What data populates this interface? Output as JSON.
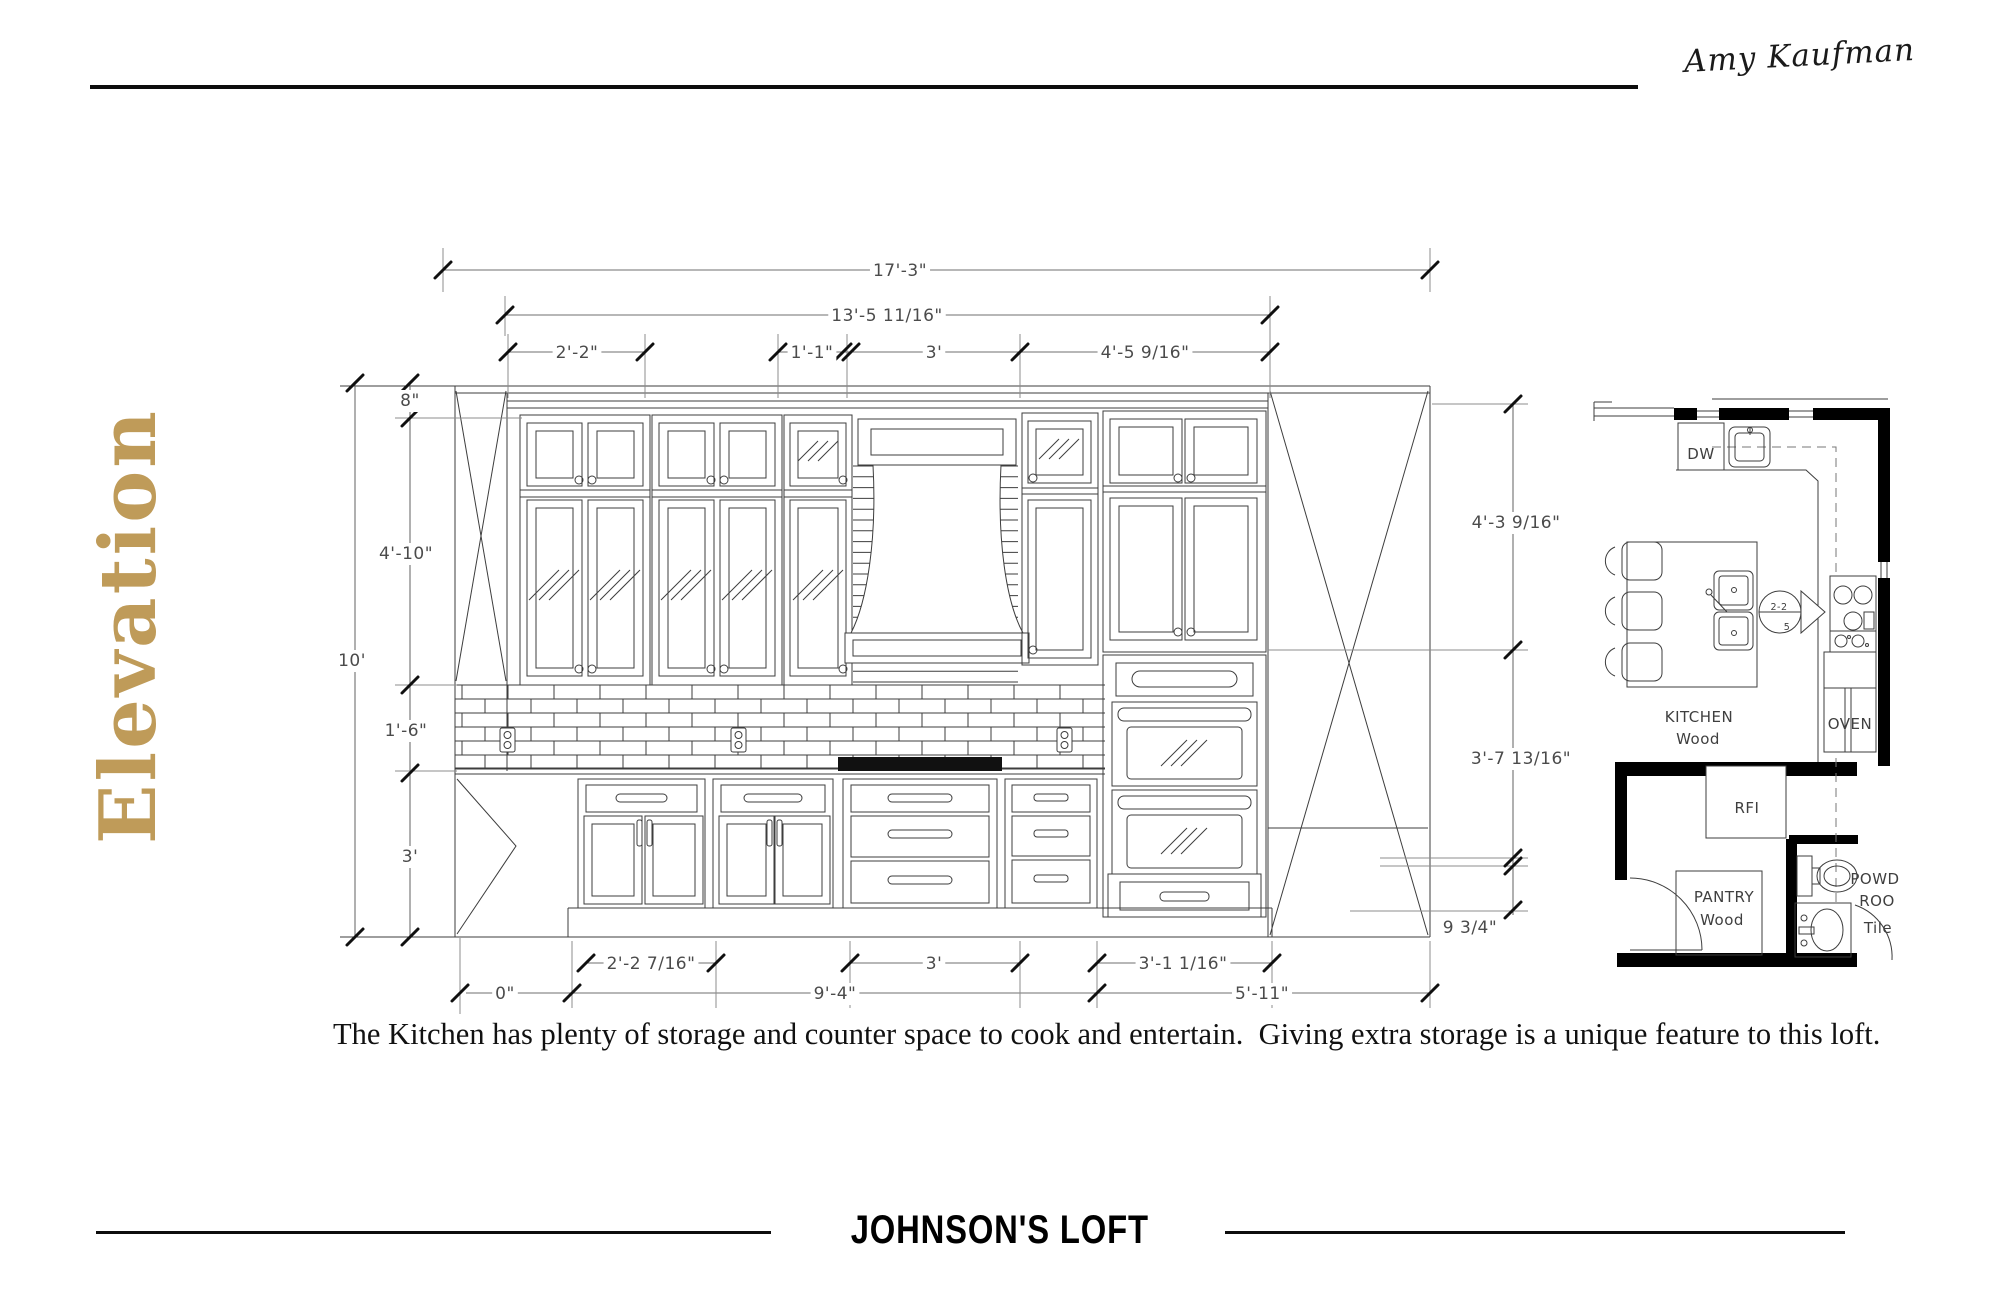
{
  "header": {
    "signature": "Amy Kaufman"
  },
  "page": {
    "title": "Elevation",
    "accent_color": "#bf9b59"
  },
  "description": "The Kitchen has plenty of storage and counter space to cook and entertain.  Giving extra storage is a unique feature to this loft.",
  "footer": {
    "project": "JOHNSON'S LOFT"
  },
  "elevation": {
    "dimensions": {
      "total_width": "17'-3\"",
      "cabinet_width": "13'-5 11/16\"",
      "seg_a": "2'-2\"",
      "seg_b": "1'-1\"",
      "seg_c": "3'",
      "seg_d": "4'-5 9/16\"",
      "left_soffit": "8\"",
      "left_upper": "4'-10\"",
      "left_total": "10'",
      "left_backsplash": "1'-6\"",
      "left_base": "3'",
      "right_a": "4'-3 9/16\"",
      "right_b": "3'-7 13/16\"",
      "right_c": "9 3/4\"",
      "bot_a": "2'-2 7/16\"",
      "bot_b": "3'",
      "bot_c": "3'-1 1/16\"",
      "zero": "0\"",
      "bot_d": "9'-4\"",
      "bot_e": "5'-11\""
    }
  },
  "floor_plan": {
    "labels": {
      "dw": "DW",
      "kitchen": "KITCHEN",
      "kitchen_floor": "Wood",
      "oven": "OVEN",
      "fridge": "RFI",
      "pantry": "PANTRY",
      "pantry_floor": "Wood",
      "powder_line1": "POWD",
      "powder_line2": "ROO",
      "powder_floor": "Tile",
      "marker_ref": "2-2",
      "marker_num": "5"
    }
  }
}
